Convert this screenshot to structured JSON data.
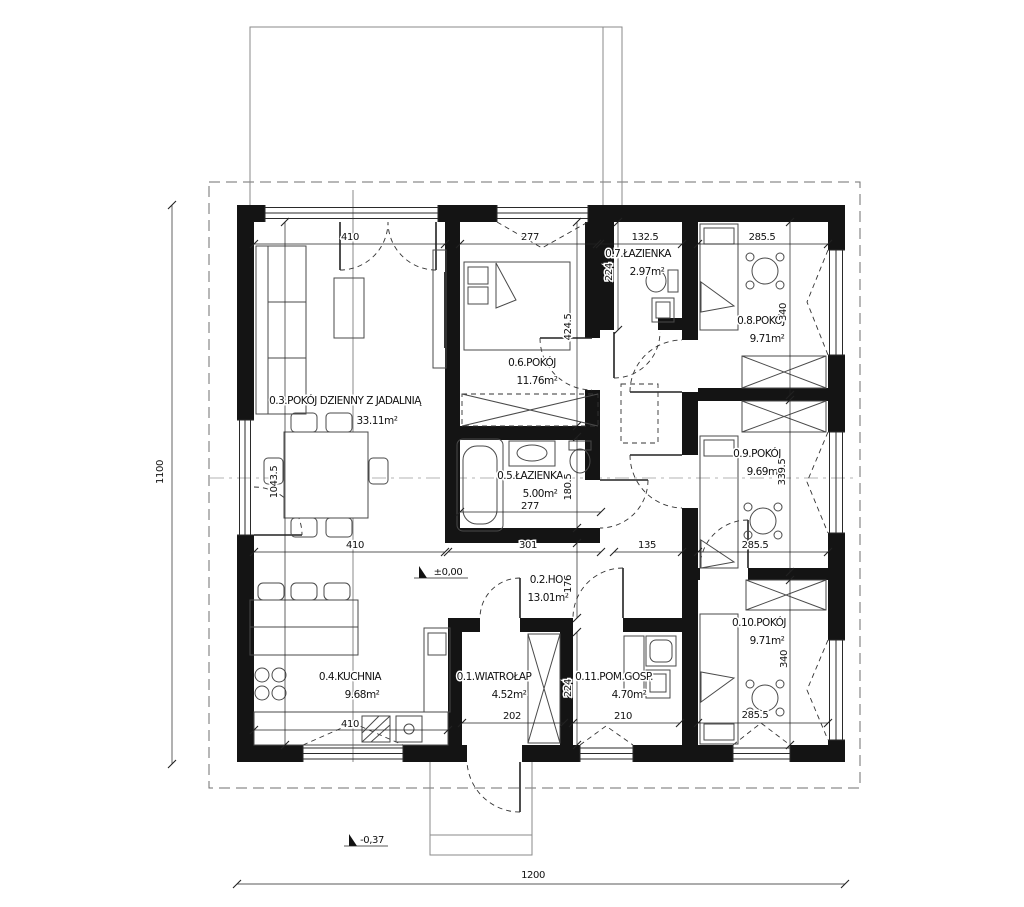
{
  "rooms": {
    "r01": {
      "name": "0.1.WIATROŁAP",
      "area": "4.52m²"
    },
    "r02": {
      "name": "0.2.HOL",
      "area": "13.01m²"
    },
    "r03": {
      "name": "0.3.POKÓJ DZIENNY Z JADALNIĄ",
      "area": "33.11m²"
    },
    "r04": {
      "name": "0.4.KUCHNIA",
      "area": "9.68m²"
    },
    "r05": {
      "name": "0.5.ŁAZIENKA",
      "area": "5.00m²"
    },
    "r06": {
      "name": "0.6.POKÓJ",
      "area": "11.76m²"
    },
    "r07": {
      "name": "0.7.ŁAZIENKA",
      "area": "2.97m²"
    },
    "r08": {
      "name": "0.8.POKÓJ",
      "area": "9.71m²"
    },
    "r09": {
      "name": "0.9.POKÓJ",
      "area": "9.69m²"
    },
    "r10": {
      "name": "0.10.POKÓJ",
      "area": "9.71m²"
    },
    "r11": {
      "name": "0.11.POM.GOSP.",
      "area": "4.70m²"
    }
  },
  "dims": {
    "top": {
      "living": "410",
      "room6": "277",
      "bath7": "132.5",
      "room8": "285.5"
    },
    "mid": {
      "living": "410",
      "bath5": "301",
      "corridor": "135",
      "room9": "285.5"
    },
    "bath5_width": "277",
    "bottom": {
      "kitchen": "410",
      "wiatrolap": "202",
      "pomgosp": "210",
      "room10": "285.5"
    },
    "vertical": {
      "total": "1100",
      "living": "1043.5",
      "bath7": "224",
      "room6": "424.5",
      "bath5": "180.5",
      "hol": "176",
      "wiatrolap": "224",
      "room8": "340",
      "room9": "339.5",
      "room10": "340"
    },
    "total_width": "1200"
  },
  "levels": {
    "ground": "±0,00",
    "outside": "-0,37"
  }
}
